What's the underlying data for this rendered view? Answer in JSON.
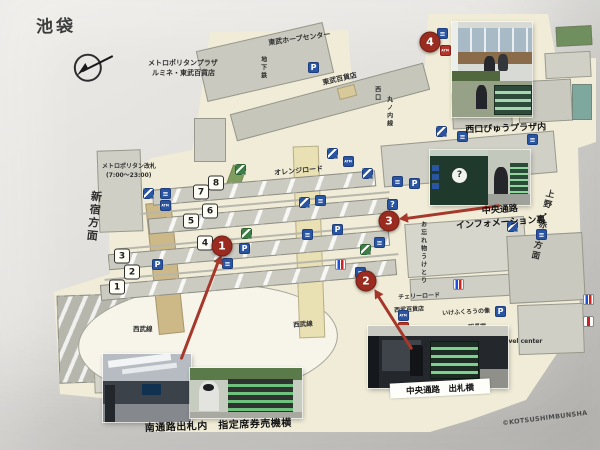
{
  "page": {
    "title": "池袋",
    "copyright": "©KOTSUSHIMBUNSHA"
  },
  "colors": {
    "marker_red": "#9a2b20",
    "icon_blue": "#2a55a2",
    "map_cream": "#f0ecd7",
    "arrow_red": "#a5372b"
  },
  "captions": {
    "photo_south": "南通路出札内　指定席券売機横",
    "photo_central_ticket": "中央通路　出札横",
    "photo_info_line1": "中央通路",
    "photo_info_line2": "インフォメーション裏",
    "photo_viewplaza": "西口びゅうプラザ内",
    "info_booth_question_mark": "?"
  },
  "markers": [
    {
      "name": "marker-1",
      "num": "1",
      "x": 222,
      "y": 246
    },
    {
      "name": "marker-2",
      "num": "2",
      "x": 366,
      "y": 281
    },
    {
      "name": "marker-3",
      "num": "3",
      "x": 389,
      "y": 221
    },
    {
      "name": "marker-4",
      "num": "4",
      "x": 430,
      "y": 42
    }
  ],
  "platforms": [
    {
      "num": "1",
      "x": 117,
      "y": 287
    },
    {
      "num": "2",
      "x": 132,
      "y": 272
    },
    {
      "num": "3",
      "x": 122,
      "y": 256
    },
    {
      "num": "4",
      "x": 205,
      "y": 243
    },
    {
      "num": "5",
      "x": 191,
      "y": 221
    },
    {
      "num": "6",
      "x": 210,
      "y": 211
    },
    {
      "num": "7",
      "x": 201,
      "y": 192
    },
    {
      "num": "8",
      "x": 216,
      "y": 183
    }
  ],
  "labels": [
    {
      "name": "label-metropolitan-plaza",
      "text": "メトロポリタンプラザ",
      "x": 148,
      "y": 60,
      "fs": 7
    },
    {
      "name": "label-lumine-tobu",
      "text": "ルミネ・東武百貨店",
      "x": 152,
      "y": 70,
      "fs": 7
    },
    {
      "name": "label-tobu-hope-center",
      "text": "東武ホープセンター",
      "x": 268,
      "y": 40,
      "fs": 7,
      "rot": -8
    },
    {
      "name": "label-tobu-department-store",
      "text": "東武百貨店",
      "x": 322,
      "y": 80,
      "fs": 7,
      "rot": -13
    },
    {
      "name": "label-metropolitan-gate",
      "text": "メトロポリタン改札",
      "x": 102,
      "y": 164,
      "fs": 6
    },
    {
      "name": "label-metropolitan-gate-hours",
      "text": "(7:00〜23:00)",
      "x": 106,
      "y": 173,
      "fs": 6
    },
    {
      "name": "label-shinjuku-direction",
      "text": "新宿方面",
      "x": 90,
      "y": 190,
      "fs": 11,
      "rot": 6,
      "vert": true
    },
    {
      "name": "label-orange-road",
      "text": "オレンジロード",
      "x": 274,
      "y": 170,
      "fs": 7,
      "rot": -5
    },
    {
      "name": "label-ueno-akabane-direction",
      "text": "上野・赤羽方面",
      "x": 545,
      "y": 188,
      "fs": 8.5,
      "rot": 13,
      "vert": true
    },
    {
      "name": "label-seibu-line",
      "text": "西武線",
      "x": 133,
      "y": 326,
      "fs": 6.5
    },
    {
      "name": "label-seibu-line",
      "text": "西武線",
      "x": 293,
      "y": 322,
      "fs": 6.5,
      "rot": -4
    },
    {
      "name": "label-cherry-road",
      "text": "チェリーロード",
      "x": 398,
      "y": 295,
      "fs": 6,
      "rot": -3
    },
    {
      "name": "label-seibu-department-store",
      "text": "西武百貨店",
      "x": 394,
      "y": 308,
      "fs": 6,
      "rot": -3
    },
    {
      "name": "label-ikefukuro-statue",
      "text": "いけふくろうの像",
      "x": 442,
      "y": 311,
      "fs": 6,
      "rot": -3
    },
    {
      "name": "label-stationmaster-office",
      "text": "駅長室",
      "x": 468,
      "y": 325,
      "fs": 6,
      "rot": -3
    },
    {
      "name": "label-subway",
      "text": "地下鉄",
      "x": 259,
      "y": 56,
      "fs": 6,
      "vert": true
    },
    {
      "name": "label-west-exit",
      "text": "西口",
      "x": 373,
      "y": 86,
      "fs": 6,
      "vert": true
    },
    {
      "name": "label-marunouchi-line",
      "text": "丸ノ内線",
      "x": 385,
      "y": 96,
      "fs": 6,
      "vert": true
    },
    {
      "name": "label-lost-and-found",
      "text": "お忘れ物うけとり",
      "x": 419,
      "y": 221,
      "fs": 6,
      "vert": true
    },
    {
      "name": "label-travel-center",
      "text": "Travel center",
      "x": 498,
      "y": 339,
      "fs": 6
    }
  ],
  "icons": [
    {
      "name": "parking-icon",
      "t": "p",
      "x": 308,
      "y": 62
    },
    {
      "name": "escalator-icon",
      "t": "esc",
      "x": 143,
      "y": 188
    },
    {
      "name": "sign-icon",
      "t": "sq",
      "x": 160,
      "y": 188
    },
    {
      "name": "atm-icon",
      "t": "atm",
      "x": 160,
      "y": 200
    },
    {
      "name": "parking-icon",
      "t": "p",
      "x": 152,
      "y": 259
    },
    {
      "name": "parking-icon",
      "t": "p",
      "x": 239,
      "y": 243
    },
    {
      "name": "sign-icon",
      "t": "sq",
      "x": 222,
      "y": 258
    },
    {
      "name": "guide-icon",
      "t": "green",
      "x": 241,
      "y": 228
    },
    {
      "name": "guide-icon",
      "t": "green",
      "x": 235,
      "y": 164
    },
    {
      "name": "escalator-icon",
      "t": "esc",
      "x": 299,
      "y": 197
    },
    {
      "name": "sign-icon",
      "t": "sq",
      "x": 315,
      "y": 195
    },
    {
      "name": "parking-icon",
      "t": "p",
      "x": 332,
      "y": 224
    },
    {
      "name": "sign-icon",
      "t": "sq",
      "x": 302,
      "y": 229
    },
    {
      "name": "guide-icon",
      "t": "green",
      "x": 360,
      "y": 244
    },
    {
      "name": "sign-icon",
      "t": "sq",
      "x": 374,
      "y": 237
    },
    {
      "name": "restroom-icon",
      "t": "wc",
      "x": 335,
      "y": 259
    },
    {
      "name": "sign-icon",
      "t": "sq",
      "x": 355,
      "y": 267
    },
    {
      "name": "information-icon",
      "t": "info",
      "x": 387,
      "y": 199
    },
    {
      "name": "sign-icon",
      "t": "sq",
      "x": 392,
      "y": 176
    },
    {
      "name": "parking-icon",
      "t": "p",
      "x": 409,
      "y": 178
    },
    {
      "name": "escalator-icon",
      "t": "esc",
      "x": 362,
      "y": 168
    },
    {
      "name": "escalator-icon",
      "t": "esc",
      "x": 327,
      "y": 148
    },
    {
      "name": "atm-icon",
      "t": "atm",
      "x": 343,
      "y": 156
    },
    {
      "name": "escalator-icon",
      "t": "esc",
      "x": 436,
      "y": 126
    },
    {
      "name": "sign-icon",
      "t": "sq",
      "x": 457,
      "y": 131
    },
    {
      "name": "sign-icon",
      "t": "sq",
      "x": 527,
      "y": 134
    },
    {
      "name": "escalator-icon",
      "t": "esc",
      "x": 507,
      "y": 221
    },
    {
      "name": "sign-icon",
      "t": "sq",
      "x": 536,
      "y": 229
    },
    {
      "name": "restroom-icon",
      "t": "wc",
      "x": 453,
      "y": 279
    },
    {
      "name": "parking-icon",
      "t": "p",
      "x": 495,
      "y": 306
    },
    {
      "name": "atm-icon",
      "t": "atm",
      "x": 398,
      "y": 310
    },
    {
      "name": "atm-red-icon",
      "t": "atm-red",
      "x": 398,
      "y": 322
    },
    {
      "name": "restroom-icon",
      "t": "wc",
      "x": 583,
      "y": 294
    },
    {
      "name": "restroom-icon",
      "t": "wc2",
      "x": 583,
      "y": 316
    },
    {
      "name": "sign-icon",
      "t": "sq",
      "x": 437,
      "y": 28
    },
    {
      "name": "escalator-icon",
      "t": "esc",
      "x": 452,
      "y": 30
    },
    {
      "name": "atm-red-icon",
      "t": "atm-red",
      "x": 440,
      "y": 45
    },
    {
      "name": "sign-icon",
      "t": "sq",
      "x": 453,
      "y": 50
    },
    {
      "name": "sign-icon",
      "t": "sq",
      "x": 465,
      "y": 53
    }
  ],
  "arrows": [
    {
      "name": "arrow-to-marker-1",
      "x1": 181,
      "y1": 358,
      "x2": 221,
      "y2": 253
    },
    {
      "name": "arrow-to-marker-2",
      "x1": 412,
      "y1": 348,
      "x2": 374,
      "y2": 288
    },
    {
      "name": "arrow-to-marker-3",
      "x1": 500,
      "y1": 204,
      "x2": 399,
      "y2": 218
    }
  ]
}
